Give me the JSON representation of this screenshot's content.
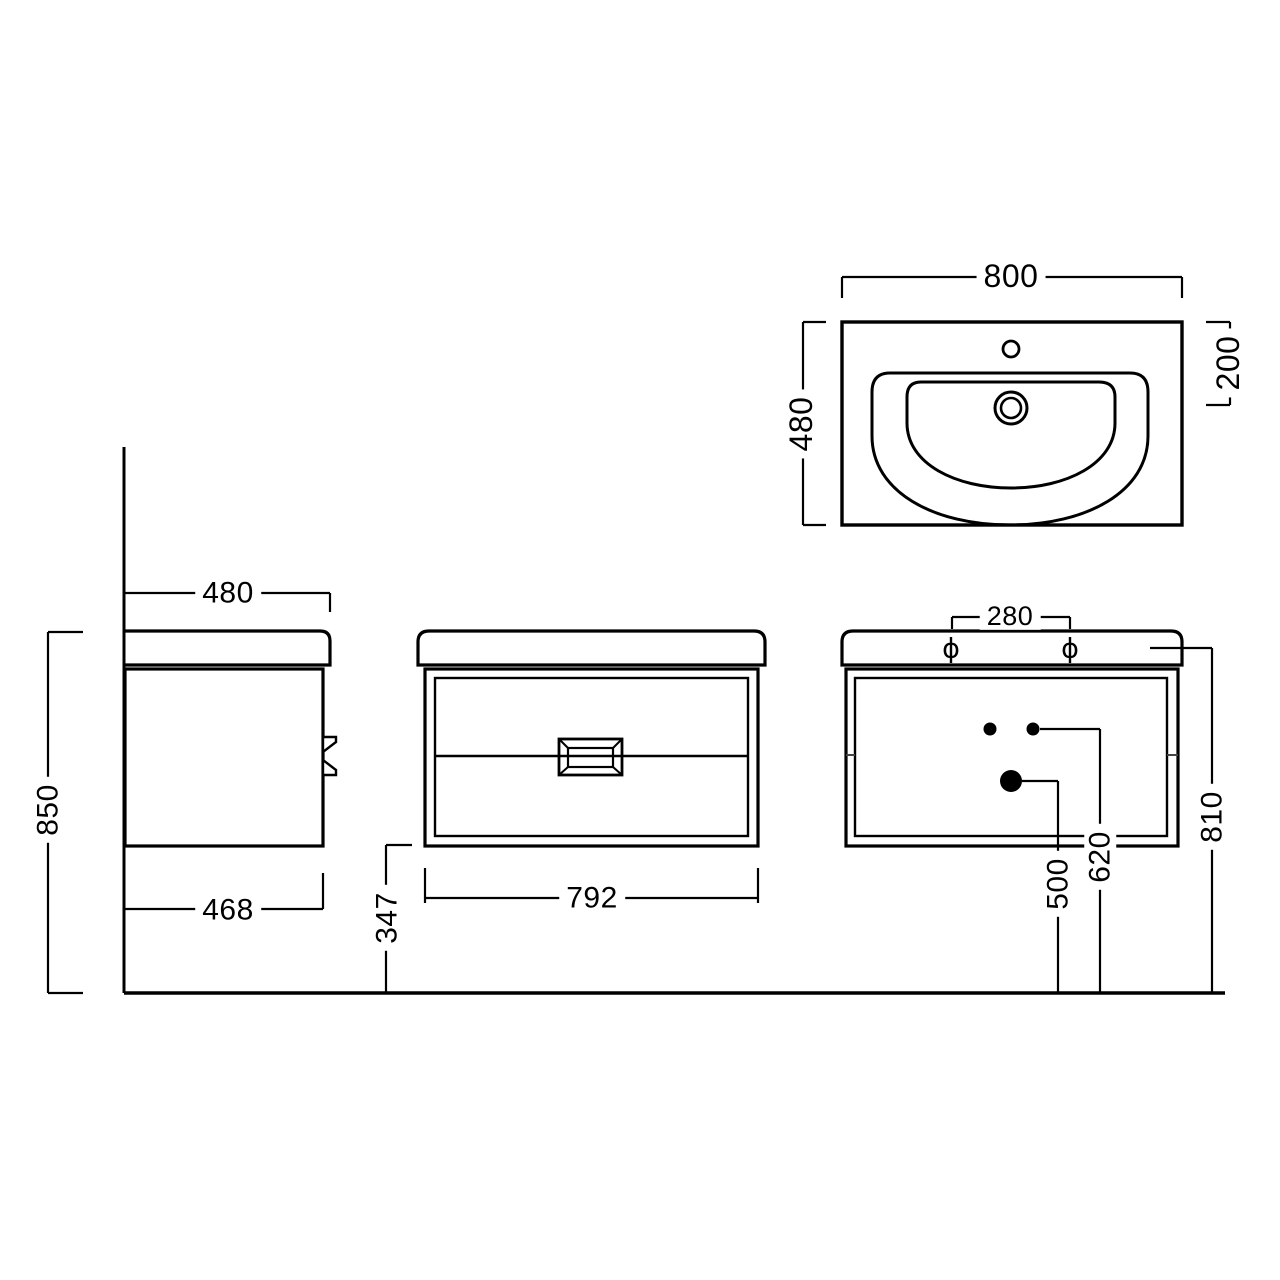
{
  "colors": {
    "background": "#ffffff",
    "line": "#000000"
  },
  "dims": {
    "d800": "800",
    "d480_plan": "480",
    "d200": "200",
    "d480_side": "480",
    "d850": "850",
    "d468": "468",
    "d347": "347",
    "d792": "792",
    "d280": "280",
    "d500": "500",
    "d620": "620",
    "d810": "810"
  },
  "symbols": {
    "diameter_mark": "ϕ"
  }
}
